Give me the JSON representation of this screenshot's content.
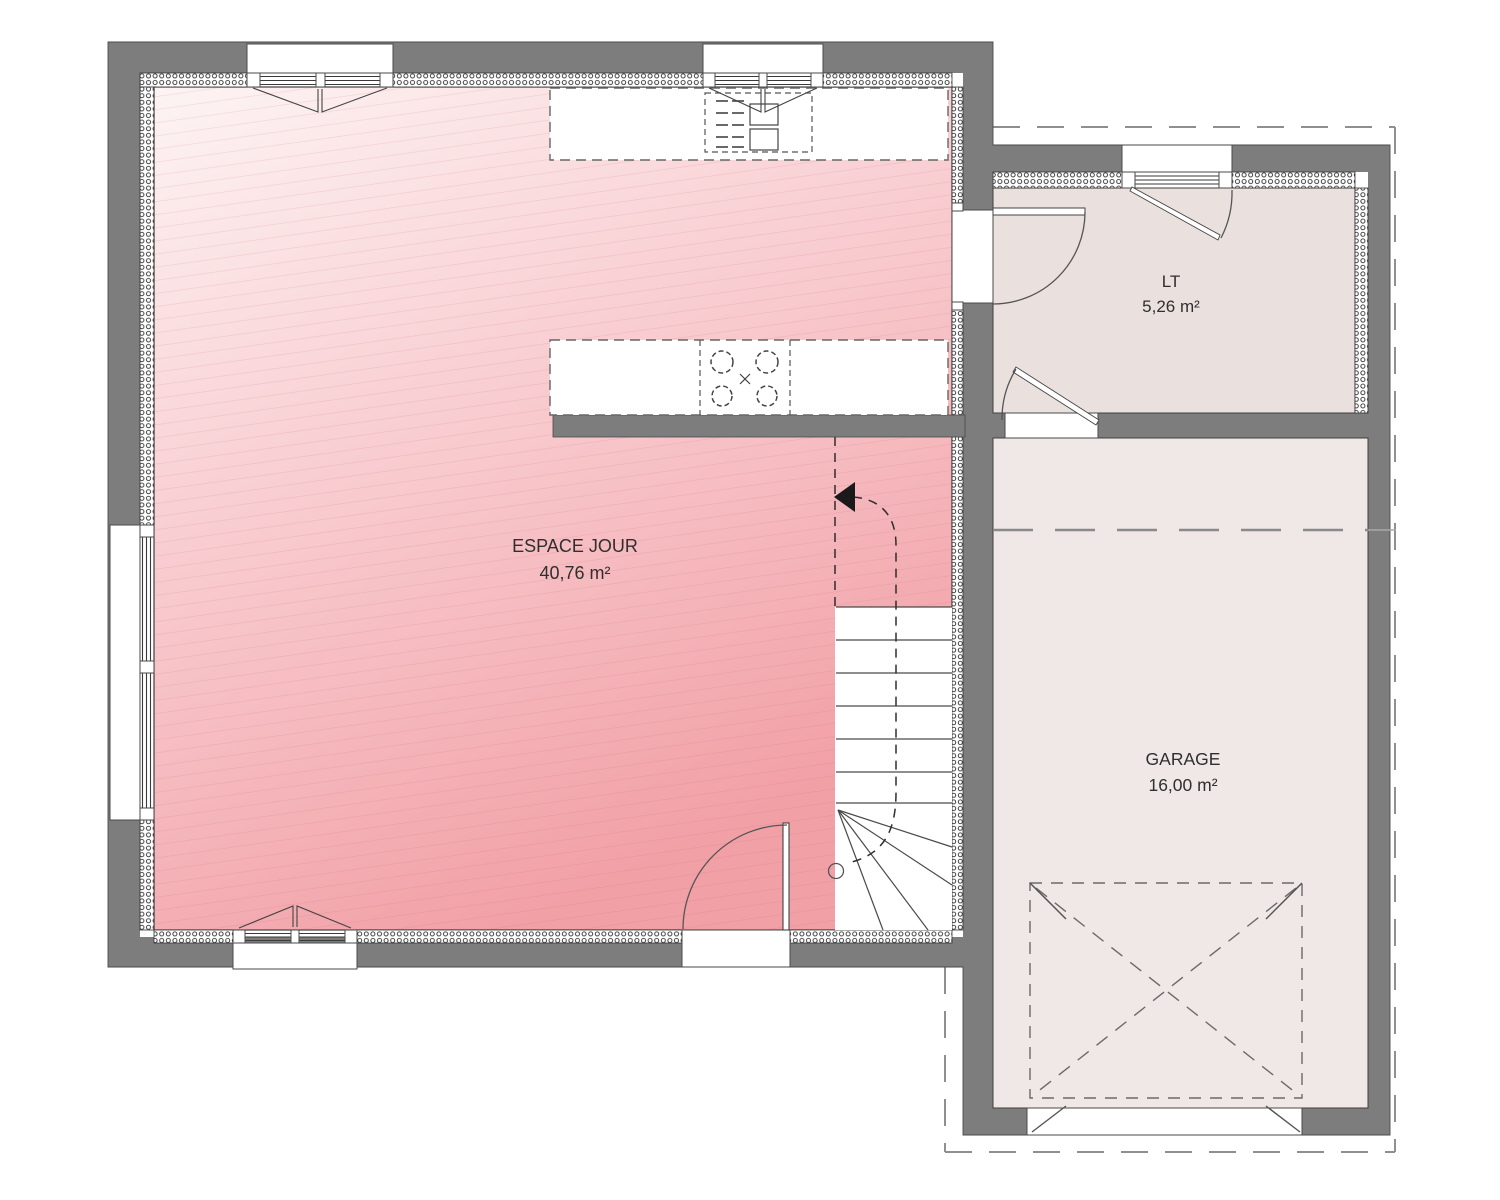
{
  "rooms": [
    {
      "name": "ESPACE JOUR",
      "area": "40,76 m²"
    },
    {
      "name": "LT",
      "area": "5,26 m²"
    },
    {
      "name": "GARAGE",
      "area": "16,00 m²"
    }
  ],
  "colors": {
    "wall": "#7d7d7d",
    "lt_floor": "#eae1df",
    "garage_floor": "#f0e8e6",
    "floor_pink_light": "#fdf4f4",
    "floor_pink_dark": "#f1a0a6",
    "outline": "#3f3f3f"
  }
}
